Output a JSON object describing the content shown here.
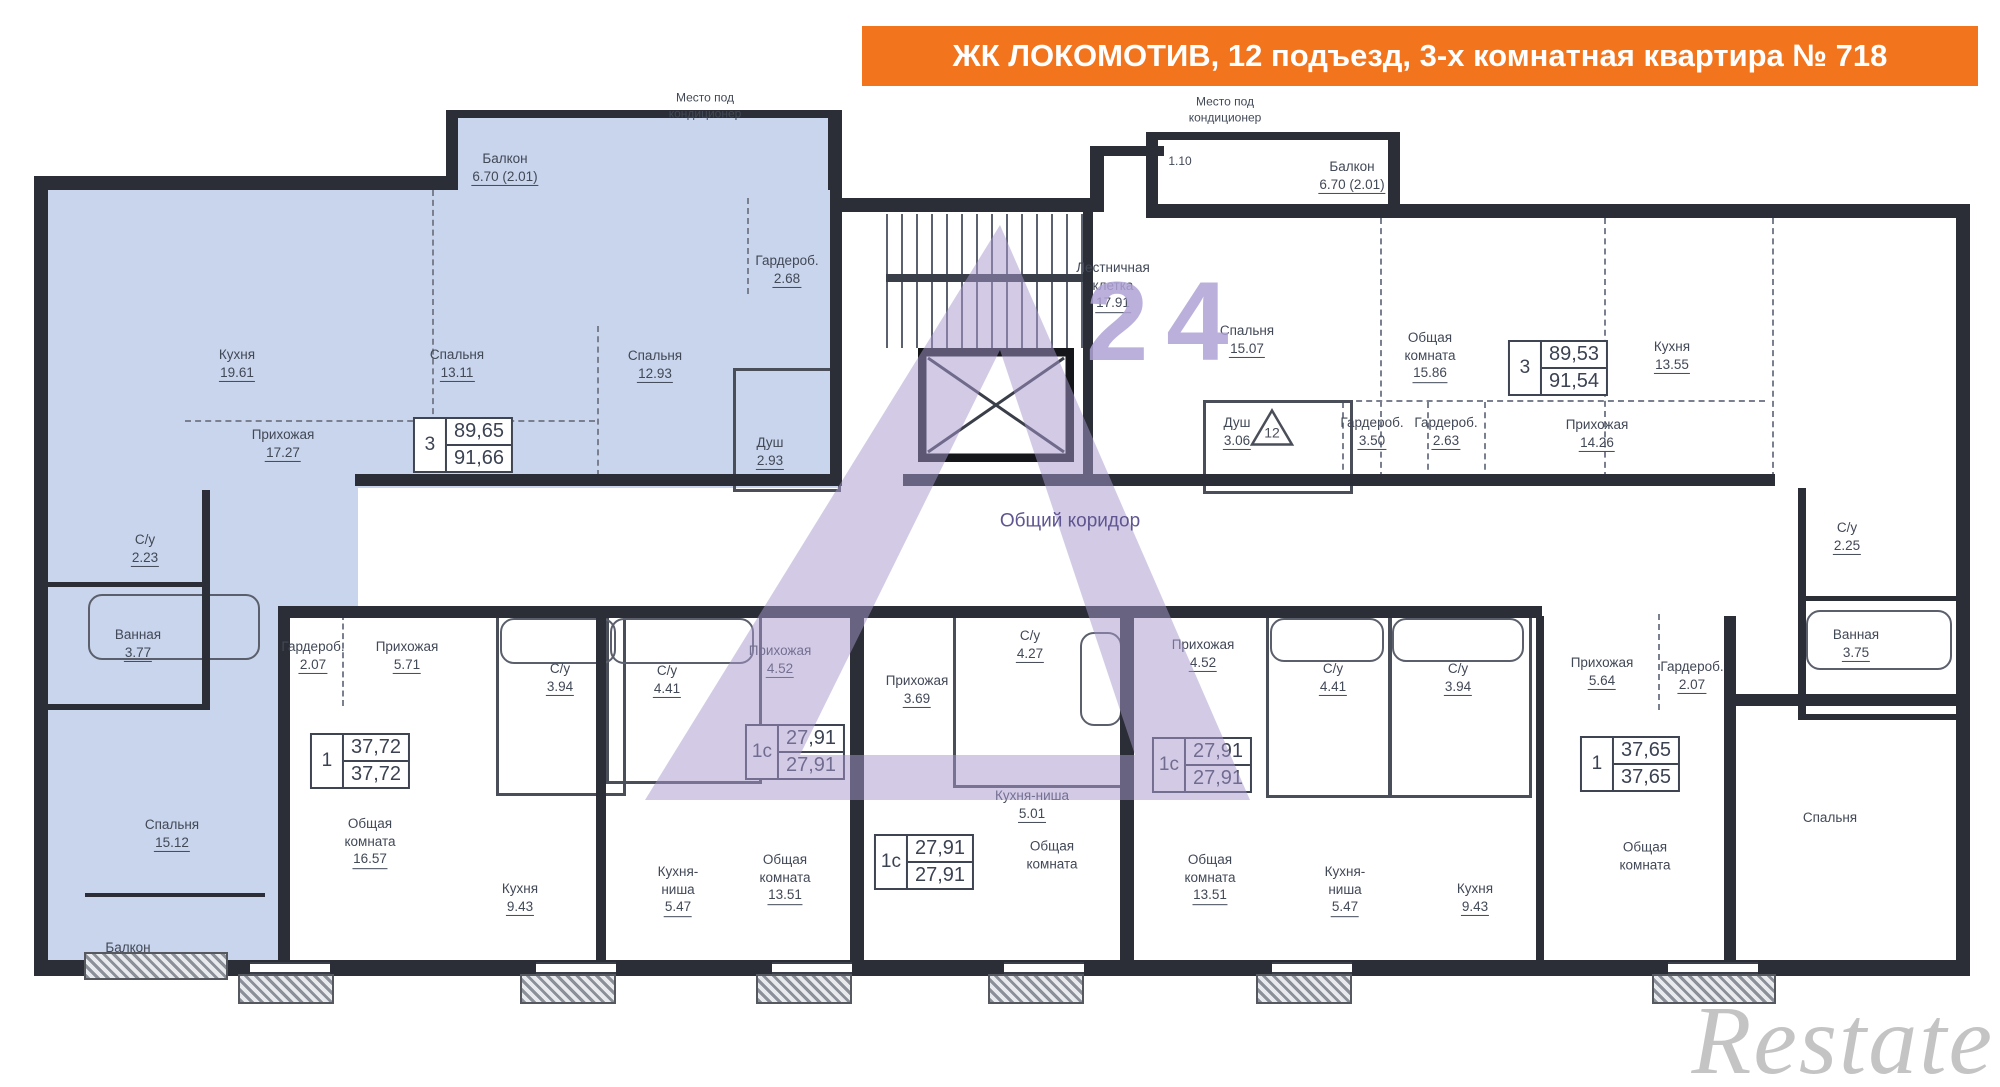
{
  "banner": {
    "text": "ЖК ЛОКОМОТИВ, 12 подъезд, 3-х комнатная квартира № 718"
  },
  "watermarks": {
    "logo_text": "24",
    "brand": "Restate",
    "corridor_note": "Общий коридор"
  },
  "colors": {
    "highlight": "#c9d5ec",
    "banner_orange": "#f2741c",
    "watermark_purple": "#a798ce",
    "wall": "#2b2e36"
  },
  "labels": [
    {
      "n": "Балкон",
      "a": "6.70 (2.01)",
      "x": 505,
      "y": 168
    },
    {
      "n": "Место под\nкондиционер",
      "a": null,
      "x": 705,
      "y": 106,
      "cls": "tiny"
    },
    {
      "n": "Гардероб.",
      "a": "2.68",
      "x": 787,
      "y": 270
    },
    {
      "n": "Кухня",
      "a": "19.61",
      "x": 237,
      "y": 364
    },
    {
      "n": "Спальня",
      "a": "13.11",
      "x": 457,
      "y": 364
    },
    {
      "n": "Спальня",
      "a": "12.93",
      "x": 655,
      "y": 365
    },
    {
      "n": "Прихожая",
      "a": "17.27",
      "x": 283,
      "y": 444
    },
    {
      "n": "Душ",
      "a": "2.93",
      "x": 770,
      "y": 452
    },
    {
      "n": "С/у",
      "a": "2.23",
      "x": 145,
      "y": 549
    },
    {
      "n": "Ванная",
      "a": "3.77",
      "x": 138,
      "y": 644
    },
    {
      "n": "Спальня",
      "a": "15.12",
      "x": 172,
      "y": 834
    },
    {
      "n": "Балкон",
      "a": null,
      "x": 128,
      "y": 948
    },
    {
      "n": "Лестничная\nклетка",
      "a": "17.91",
      "x": 1113,
      "y": 286,
      "cls": "stair"
    },
    {
      "n": "Место под\nкондиционер",
      "a": null,
      "x": 1225,
      "y": 110,
      "cls": "tiny"
    },
    {
      "n": "1.10",
      "a": null,
      "x": 1180,
      "y": 162,
      "cls": "tiny"
    },
    {
      "n": "Балкон",
      "a": "6.70 (2.01)",
      "x": 1352,
      "y": 176
    },
    {
      "n": "Спальня",
      "a": "15.07",
      "x": 1247,
      "y": 340
    },
    {
      "n": "Общая\nкомната",
      "a": "15.86",
      "x": 1430,
      "y": 356
    },
    {
      "n": "Кухня",
      "a": "13.55",
      "x": 1672,
      "y": 356
    },
    {
      "n": "Душ",
      "a": "3.06",
      "x": 1237,
      "y": 432
    },
    {
      "n": "Гардероб.",
      "a": "3.50",
      "x": 1372,
      "y": 432
    },
    {
      "n": "Гардероб.",
      "a": "2.63",
      "x": 1446,
      "y": 432
    },
    {
      "n": "Прихожая",
      "a": "14.26",
      "x": 1597,
      "y": 434
    },
    {
      "n": "С/у",
      "a": "2.25",
      "x": 1847,
      "y": 537
    },
    {
      "n": "Ванная",
      "a": "3.75",
      "x": 1856,
      "y": 644
    },
    {
      "n": "Общий коридор",
      "a": null,
      "x": 1070,
      "y": 522,
      "cls": "corridor"
    },
    {
      "n": "Гардероб.",
      "a": "2.07",
      "x": 313,
      "y": 656
    },
    {
      "n": "Прихожая",
      "a": "5.71",
      "x": 407,
      "y": 656
    },
    {
      "n": "С/у",
      "a": "3.94",
      "x": 560,
      "y": 678
    },
    {
      "n": "Общая\nкомната",
      "a": "16.57",
      "x": 370,
      "y": 842
    },
    {
      "n": "Кухня",
      "a": "9.43",
      "x": 520,
      "y": 898
    },
    {
      "n": "С/у",
      "a": "4.41",
      "x": 667,
      "y": 680
    },
    {
      "n": "Прихожая",
      "a": "4.52",
      "x": 780,
      "y": 660
    },
    {
      "n": "Кухня-\nниша",
      "a": "5.47",
      "x": 678,
      "y": 890
    },
    {
      "n": "Общая\nкомната",
      "a": "13.51",
      "x": 785,
      "y": 878
    },
    {
      "n": "Прихожая",
      "a": "3.69",
      "x": 917,
      "y": 690
    },
    {
      "n": "С/у",
      "a": "4.27",
      "x": 1030,
      "y": 645
    },
    {
      "n": "Кухня-ниша",
      "a": "5.01",
      "x": 1032,
      "y": 805
    },
    {
      "n": "Общая\nкомната",
      "a": null,
      "x": 1052,
      "y": 855
    },
    {
      "n": "Прихожая",
      "a": "4.52",
      "x": 1203,
      "y": 654
    },
    {
      "n": "Общая\nкомната",
      "a": "13.51",
      "x": 1210,
      "y": 878
    },
    {
      "n": "С/у",
      "a": "4.41",
      "x": 1333,
      "y": 678
    },
    {
      "n": "С/у",
      "a": "3.94",
      "x": 1458,
      "y": 678
    },
    {
      "n": "Кухня-\nниша",
      "a": "5.47",
      "x": 1345,
      "y": 890
    },
    {
      "n": "Кухня",
      "a": "9.43",
      "x": 1475,
      "y": 898
    },
    {
      "n": "Прихожая",
      "a": "5.64",
      "x": 1602,
      "y": 672
    },
    {
      "n": "Гардероб.",
      "a": "2.07",
      "x": 1692,
      "y": 676
    },
    {
      "n": "Общая\nкомната",
      "a": null,
      "x": 1645,
      "y": 856
    },
    {
      "n": "Спальня",
      "a": null,
      "x": 1830,
      "y": 818
    }
  ],
  "markers": [
    {
      "type": "triangle",
      "text": "12",
      "x": 1272,
      "y": 430
    }
  ],
  "spec_boxes": [
    {
      "rooms": "3",
      "area": "89,65",
      "total": "91,66",
      "x": 463,
      "y": 445
    },
    {
      "rooms": "3",
      "area": "89,53",
      "total": "91,54",
      "x": 1558,
      "y": 368
    },
    {
      "rooms": "1",
      "area": "37,72",
      "total": "37,72",
      "x": 360,
      "y": 761
    },
    {
      "rooms": "1с",
      "area": "27,91",
      "total": "27,91",
      "x": 795,
      "y": 752
    },
    {
      "rooms": "1с",
      "area": "27,91",
      "total": "27,91",
      "x": 924,
      "y": 862
    },
    {
      "rooms": "1с",
      "area": "27,91",
      "total": "27,91",
      "x": 1202,
      "y": 765
    },
    {
      "rooms": "1",
      "area": "37,65",
      "total": "37,65",
      "x": 1630,
      "y": 764
    }
  ]
}
